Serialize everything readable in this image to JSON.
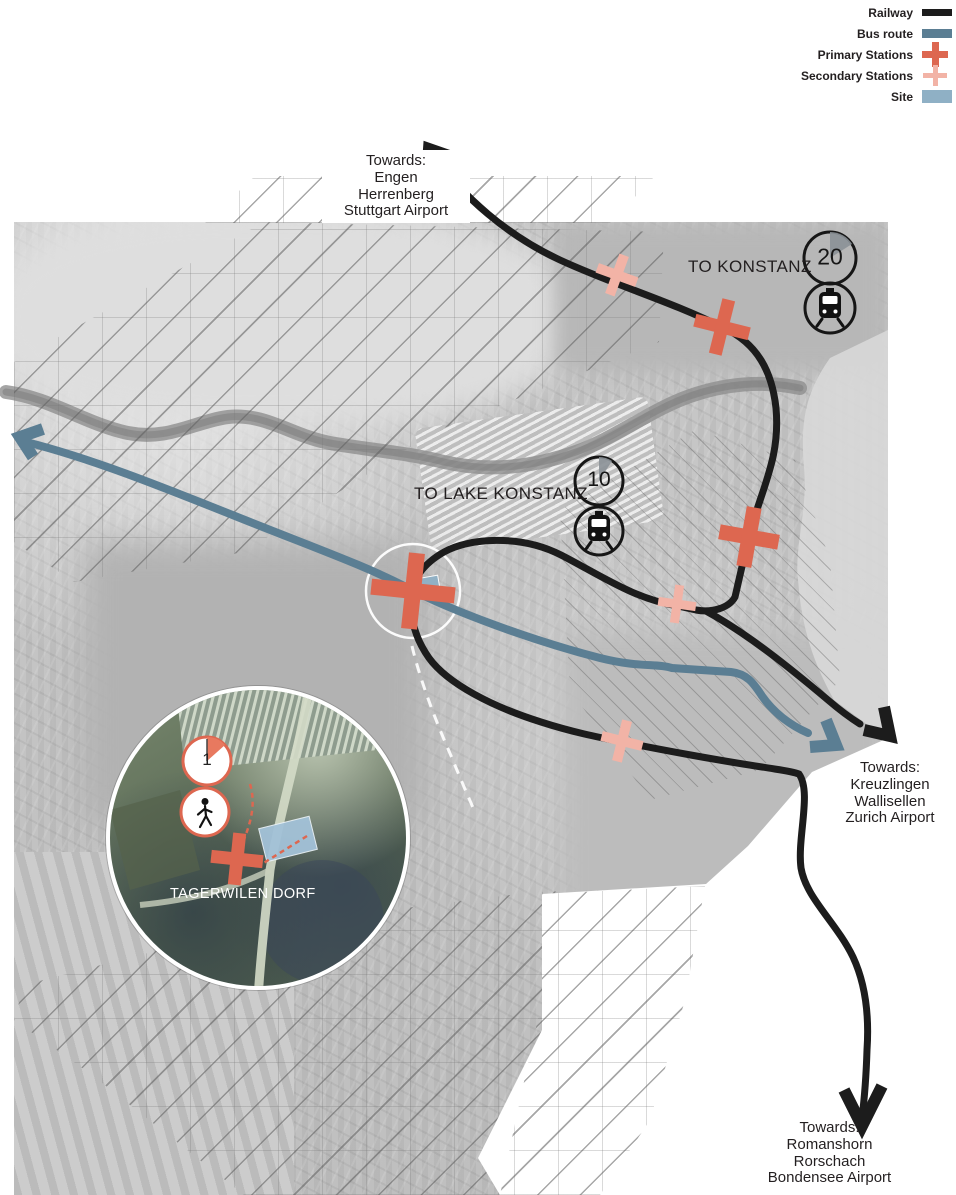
{
  "legend": {
    "items": [
      {
        "label": "Railway",
        "type": "railway-line"
      },
      {
        "label": "Bus route",
        "type": "bus-line"
      },
      {
        "label": "Primary Stations",
        "type": "primary-cross"
      },
      {
        "label": "Secondary Stations",
        "type": "secondary-cross"
      },
      {
        "label": "Site",
        "type": "site-swatch"
      }
    ]
  },
  "colors": {
    "railway": "#1c1c1c",
    "bus": "#5b7e93",
    "primary": "#dd6750",
    "secondary": "#f2b3a6",
    "site": "#8fb0c5"
  },
  "map_labels": {
    "to_konstanz": "TO KONSTANZ",
    "to_lake_konstanz": "TO LAKE KONSTANZ"
  },
  "travel_times": {
    "to_konstanz_min": "20",
    "to_lake_konstanz_min": "10",
    "inset_min": "1"
  },
  "destinations": {
    "north": {
      "title": "Towards:",
      "lines": [
        "Engen",
        "Herrenberg",
        "Stuttgart Airport"
      ]
    },
    "east": {
      "title": "Towards:",
      "lines": [
        "Kreuzlingen",
        "Wallisellen",
        "Zurich Airport"
      ]
    },
    "south": {
      "title": "Towards:",
      "lines": [
        "Romanshorn",
        "Rorschach",
        "Bondensee Airport"
      ]
    }
  },
  "inset": {
    "place_label": "TAGERWILEN DORF"
  }
}
